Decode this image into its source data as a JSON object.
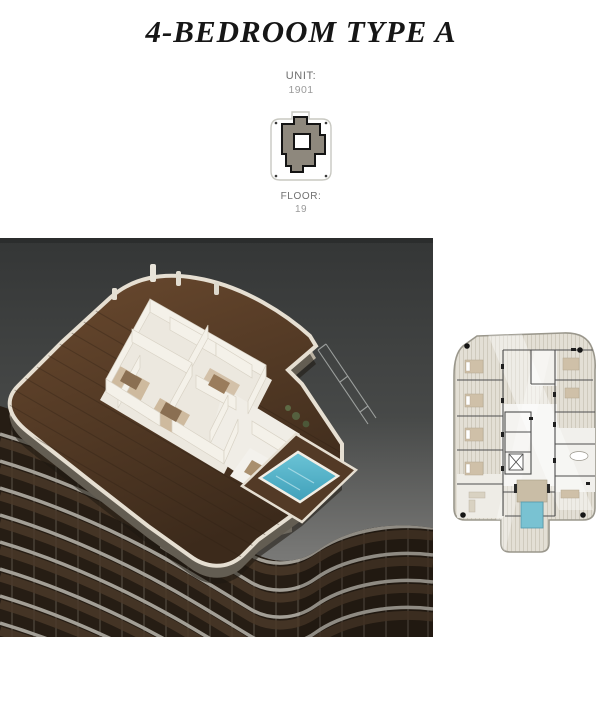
{
  "header": {
    "title": "4-BEDROOM TYPE A"
  },
  "unit": {
    "label": "UNIT:",
    "value": "1901"
  },
  "keyplan": {
    "floor_label": "FLOOR:",
    "floor_value": "19"
  },
  "palette": {
    "title_text": "#161616",
    "label_text": "#6f6f6f",
    "value_text": "#9a9a9a",
    "keyplan_unit_highlight": "#8e887d",
    "keyplan_outline": "#141414",
    "render_background_top": "#3a3c3c",
    "render_background_bottom": "#8f8f8d",
    "deck_wood": "#53392a",
    "wall_white": "#f4f1e9",
    "pool_turquoise": "#4fb4ca",
    "tower_slab": "#a39f96",
    "tower_glass": "#261d14",
    "plan_deck": "#e3dfd5",
    "plan_wall": "#4e4e4e",
    "plan_pool": "#79c2d2"
  }
}
